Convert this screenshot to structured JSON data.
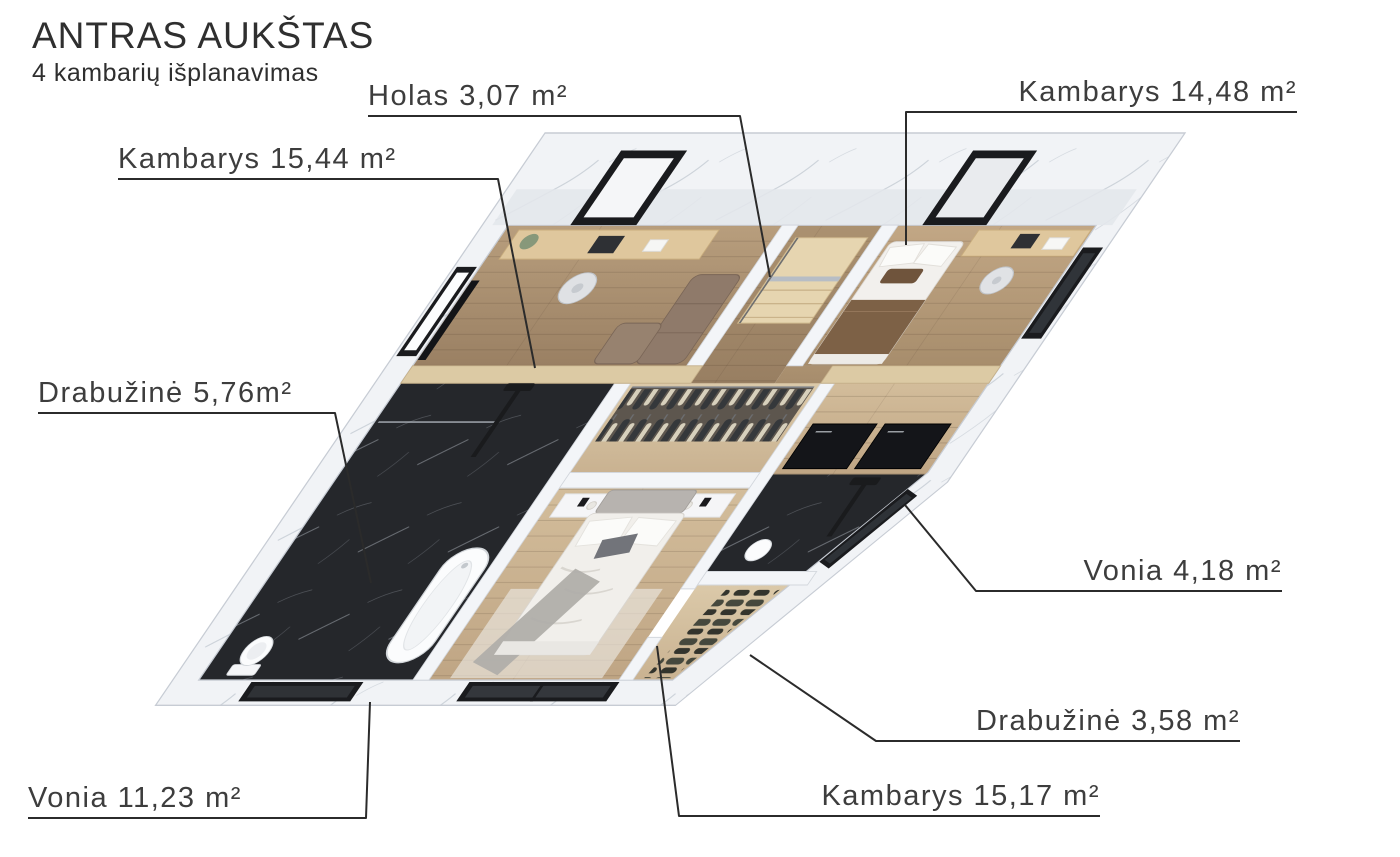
{
  "header": {
    "title": "ANTRAS AUKŠTAS",
    "subtitle": "4 kambarių išplanavimas"
  },
  "labels": {
    "holas": "Holas 3,07 m²",
    "kambarys_14_48": "Kambarys 14,48 m²",
    "kambarys_15_44": "Kambarys 15,44 m²",
    "drabuzine_5_76": "Drabužinė 5,76m²",
    "vonia_4_18": "Vonia 4,18 m²",
    "drabuzine_3_58": "Drabužinė 3,58 m²",
    "vonia_11_23": "Vonia 11,23 m²",
    "kambarys_15_17": "Kambarys 15,17 m²"
  },
  "rooms": [
    {
      "name": "Holas",
      "area_m2": "3,07"
    },
    {
      "name": "Kambarys",
      "area_m2": "14,48"
    },
    {
      "name": "Kambarys",
      "area_m2": "15,44"
    },
    {
      "name": "Drabužinė",
      "area_m2": "5,76"
    },
    {
      "name": "Vonia",
      "area_m2": "4,18"
    },
    {
      "name": "Drabužinė",
      "area_m2": "3,58"
    },
    {
      "name": "Vonia",
      "area_m2": "11,23"
    },
    {
      "name": "Kambarys",
      "area_m2": "15,17"
    }
  ],
  "colors": {
    "label_text": "#3d3d3d",
    "leader_line": "#2b2b2b",
    "wall_white": "#f1f3f6",
    "wood_floor": "#b89e7d",
    "black_marble": "#25272b",
    "dark_frames": "#1a1b1e"
  }
}
